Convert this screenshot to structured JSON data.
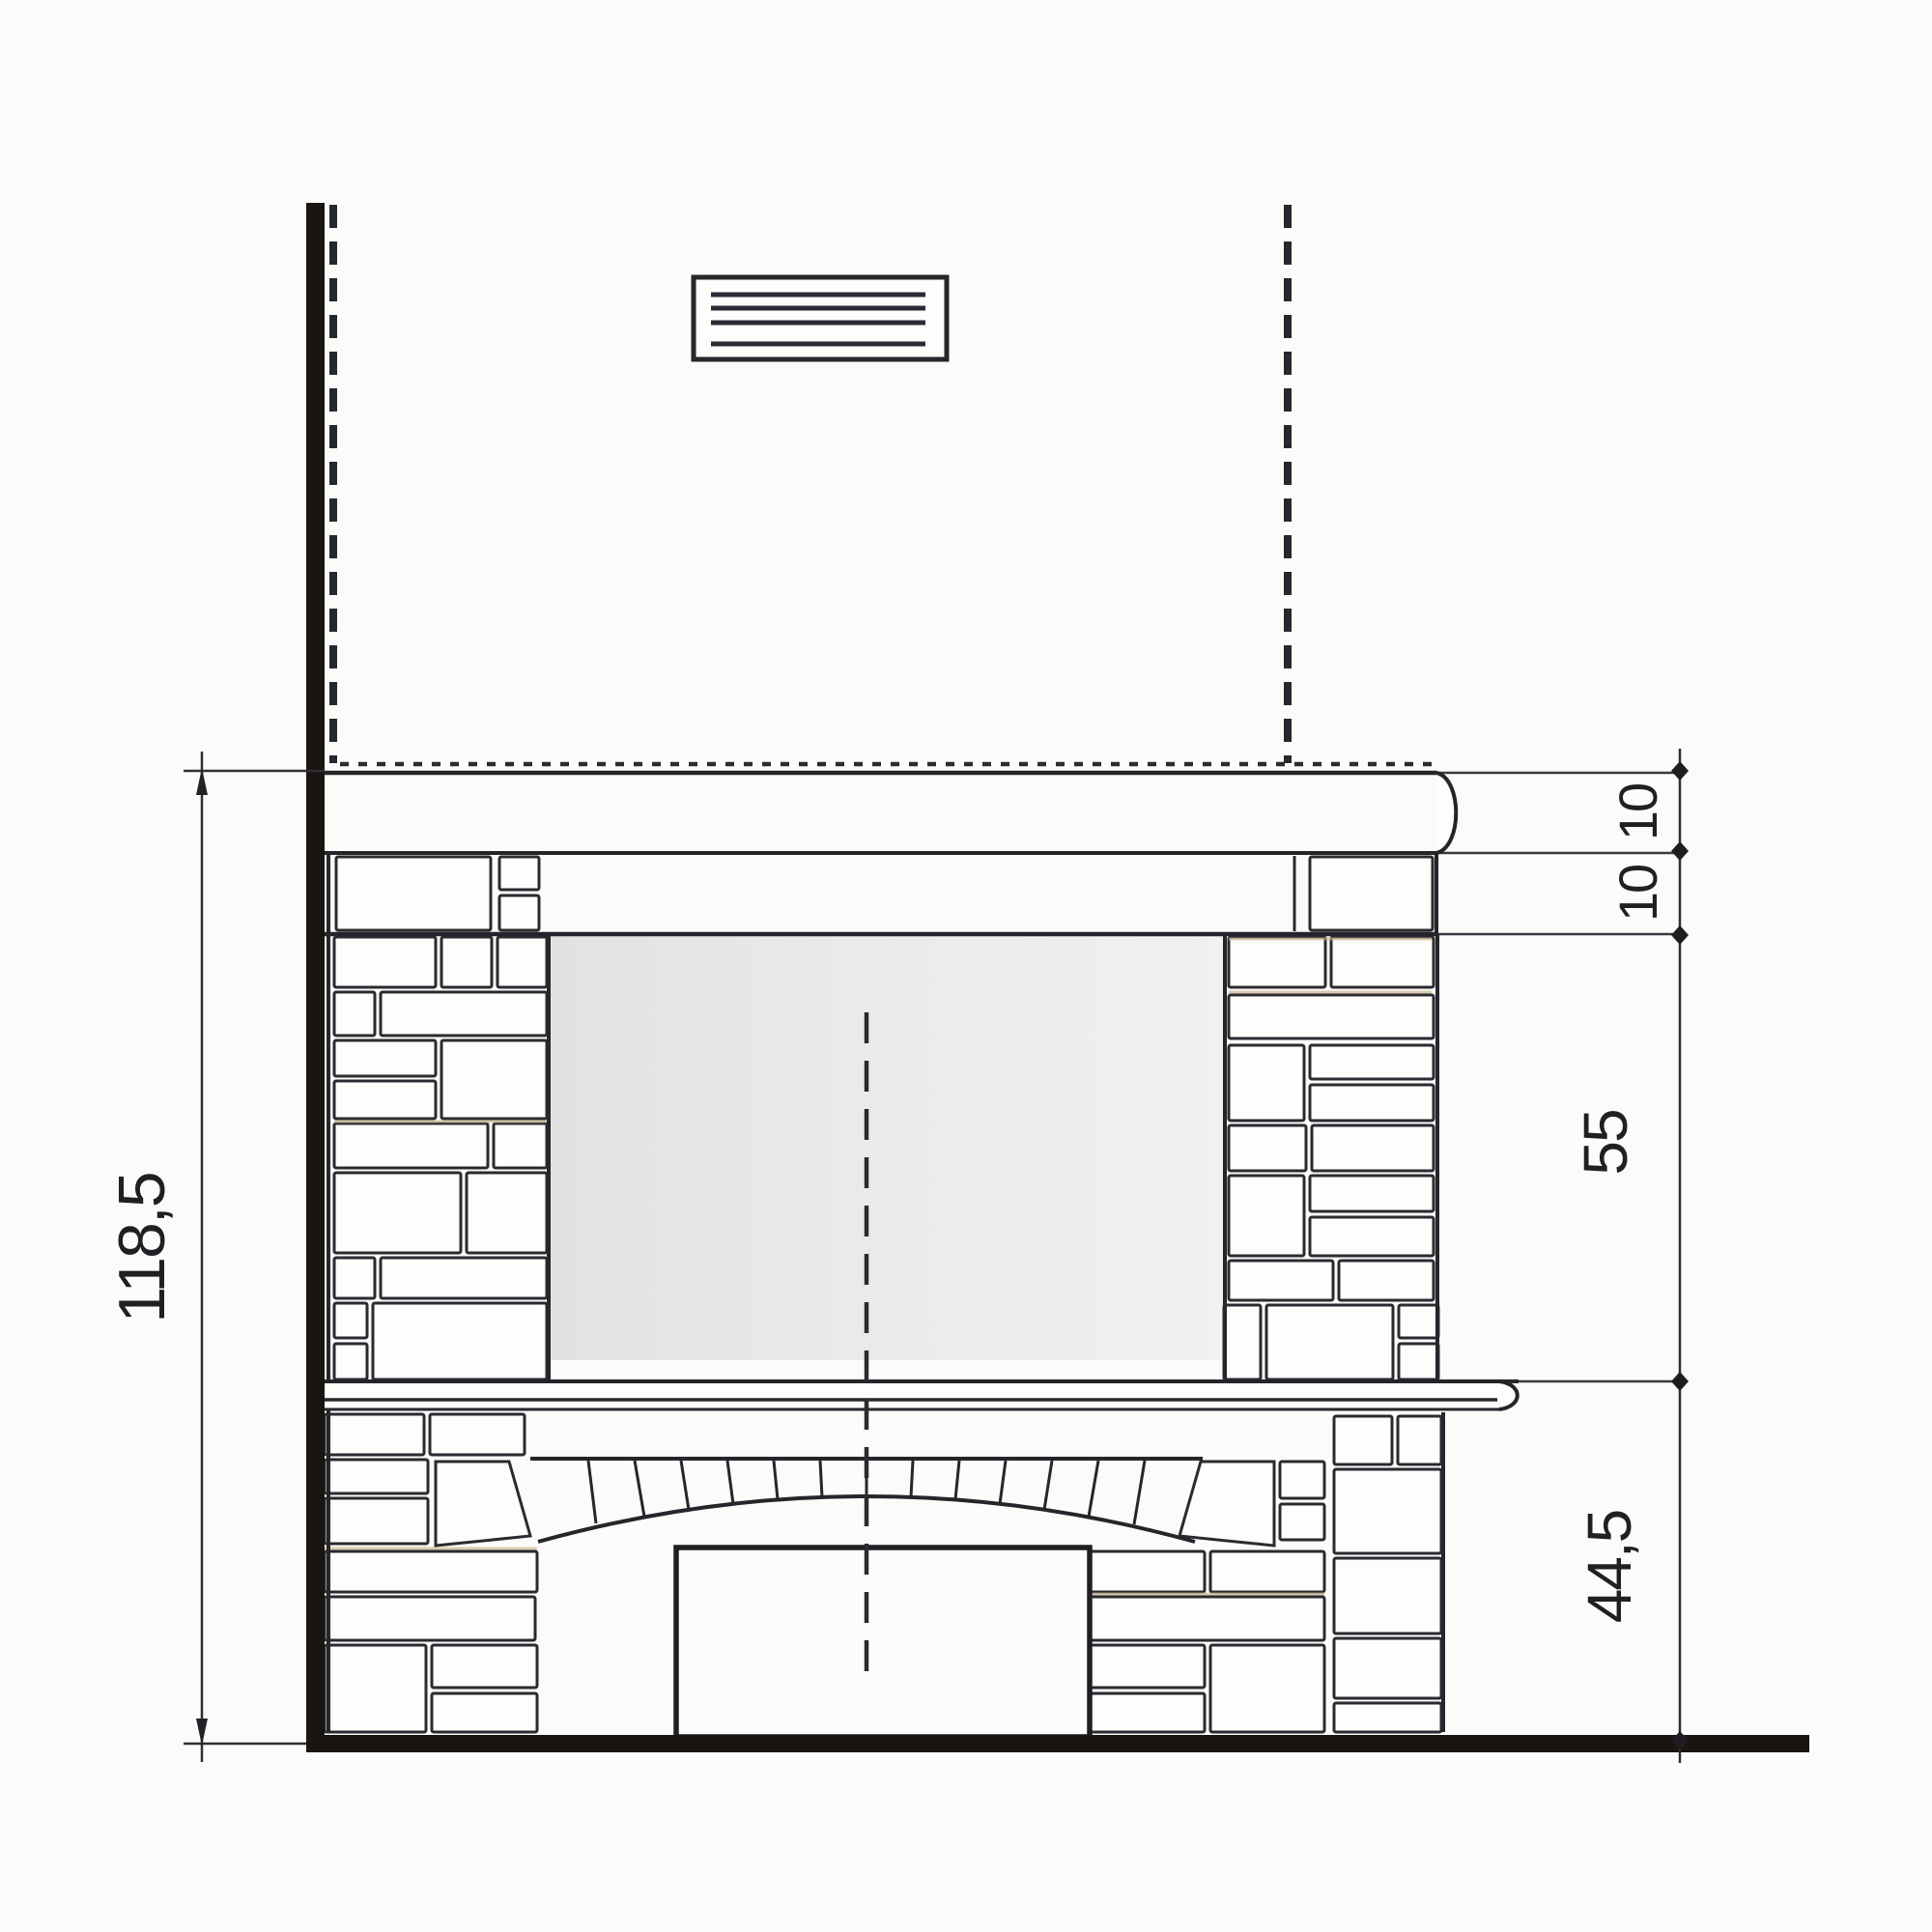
{
  "diagram": {
    "dimensions": {
      "left_total": "118,5",
      "right_cap": "10",
      "right_lintel": "10",
      "right_firebox": "55",
      "right_base": "44,5"
    },
    "colors": {
      "ink": "#26262c",
      "heavy_ink": "#1a1510",
      "firebox_grey": "#e8e8e7",
      "paper": "#fbfbfa",
      "mortar_tan": "#c8b28c"
    }
  }
}
